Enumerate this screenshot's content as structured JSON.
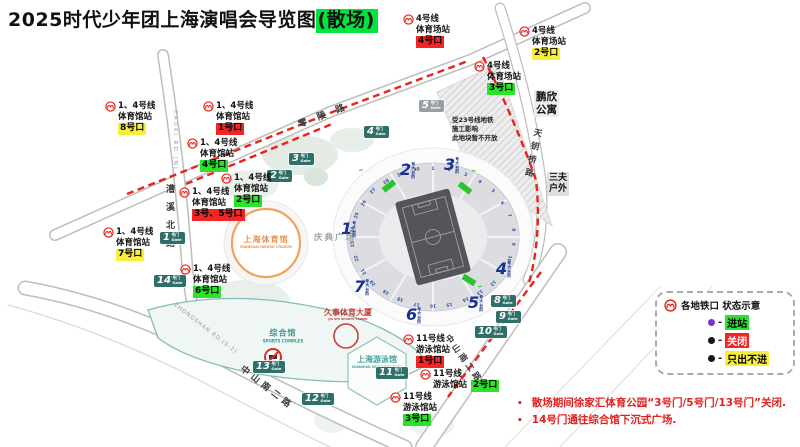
{
  "title": {
    "text": "2025时代少年团上海演唱会导览图",
    "tail": "(散场)"
  },
  "stations": [
    {
      "line": "4号线",
      "station": "体育场站",
      "exit": "4号口",
      "status": "closed",
      "x": 403,
      "y": 14
    },
    {
      "line": "4号线",
      "station": "体育场站",
      "exit": "2号口",
      "status": "exitonly",
      "x": 519,
      "y": 26
    },
    {
      "line": "4号线",
      "station": "体育场站",
      "exit": "3号口",
      "status": "open",
      "x": 474,
      "y": 61
    },
    {
      "line": "1、4号线",
      "station": "体育馆站",
      "exit": "8号口",
      "status": "exitonly",
      "x": 105,
      "y": 101
    },
    {
      "line": "1、4号线",
      "station": "体育馆站",
      "exit": "1号口",
      "status": "closed",
      "x": 203,
      "y": 101
    },
    {
      "line": "1、4号线",
      "station": "体育馆站",
      "exit": "4号口",
      "status": "open",
      "x": 187,
      "y": 138
    },
    {
      "line": "1、4号线",
      "station": "体育馆站",
      "exit": "2号口",
      "status": "open",
      "x": 221,
      "y": 173
    },
    {
      "line": "1、4号线",
      "station": "体育馆站",
      "exit": "3号、5号口",
      "status": "closed",
      "x": 179,
      "y": 187
    },
    {
      "line": "1、4号线",
      "station": "体育馆站",
      "exit": "7号口",
      "status": "exitonly",
      "x": 103,
      "y": 227
    },
    {
      "line": "1、4号线",
      "station": "体育馆站",
      "exit": "6号口",
      "status": "open",
      "x": 180,
      "y": 264
    },
    {
      "line": "11号线",
      "station": "游泳馆站",
      "exit": "1号口",
      "status": "closed",
      "x": 403,
      "y": 334
    },
    {
      "line": "11号线",
      "station": "游泳馆站",
      "exit": "2号口",
      "status": "open",
      "x": 420,
      "y": 369,
      "inline": true
    },
    {
      "line": "11号线",
      "station": "游泳馆站",
      "exit": "3号口",
      "status": "open",
      "x": 390,
      "y": 392
    }
  ],
  "gate_suffix": {
    "cn": "号门",
    "en": "Gate"
  },
  "gates": [
    {
      "num": "5",
      "x": 419,
      "y": 100,
      "closed": true
    },
    {
      "num": "4",
      "x": 364,
      "y": 126
    },
    {
      "num": "3",
      "x": 289,
      "y": 153
    },
    {
      "num": "2",
      "x": 267,
      "y": 170
    },
    {
      "num": "1",
      "x": 160,
      "y": 232
    },
    {
      "num": "14",
      "x": 154,
      "y": 275
    },
    {
      "num": "13",
      "x": 253,
      "y": 361
    },
    {
      "num": "12",
      "x": 302,
      "y": 393
    },
    {
      "num": "11",
      "x": 376,
      "y": 367
    },
    {
      "num": "10",
      "x": 475,
      "y": 326
    },
    {
      "num": "9",
      "x": 496,
      "y": 311
    },
    {
      "num": "8",
      "x": 491,
      "y": 295
    }
  ],
  "stair_suffix": "号大台阶",
  "stairs": [
    {
      "n": "1",
      "x": 341,
      "y": 221
    },
    {
      "n": "2",
      "x": 400,
      "y": 162
    },
    {
      "n": "3",
      "x": 444,
      "y": 157
    },
    {
      "n": "4",
      "x": 496,
      "y": 261
    },
    {
      "n": "5",
      "x": 468,
      "y": 295
    },
    {
      "n": "6",
      "x": 406,
      "y": 307
    },
    {
      "n": "7",
      "x": 354,
      "y": 279
    }
  ],
  "passages": [
    {
      "label": "1号内场通道",
      "x": 359,
      "y": 170,
      "rot": -10
    },
    {
      "label": "2号内场通道",
      "x": 472,
      "y": 170,
      "rot": 10
    },
    {
      "label": "3号内场通道",
      "x": 478,
      "y": 286,
      "rot": -4
    }
  ],
  "stadium": {
    "sections": [
      "1",
      "2",
      "3",
      "4",
      "5",
      "6",
      "7",
      "8",
      "9",
      "10",
      "11",
      "12",
      "13",
      "14",
      "15",
      "16",
      "17",
      "18",
      "19",
      "20",
      "21",
      "22",
      "23",
      "24",
      "25",
      "26",
      "27",
      "28",
      "29",
      "30"
    ]
  },
  "places": {
    "pengxin": "鹏欣\n公寓",
    "sanfu": "三夫\n户外",
    "plaza": "庆典广场",
    "indoor_cn": "上海体育馆",
    "indoor_en": "SHANGHAI INDOOR STADIUM",
    "complex_cn": "综合馆",
    "complex_en": "SPORTS COMPLEX",
    "swim_cn": "上海游泳馆",
    "swim_en": "SHANGHAI SWIMMING POOL",
    "tower_cn": "久事体育大厦",
    "tower_en": "JIU SHI SPORTS TOWER",
    "construction": "受23号线地铁\n施工影响\n此地块暂不开放"
  },
  "roads": {
    "lingling": "零陵路",
    "caoxi_cn": "漕溪北路",
    "caoxi_en": "CAOXI RD.(N)",
    "tianyaoqiao": "天钥桥路",
    "zhongshan_en": "ZHONGSHAN RD.(S-2)",
    "zhongshan_cn_left": "中山南二路",
    "zhongshan_cn_right": "中山南二路"
  },
  "legend": {
    "title": "各地铁口 状态示意",
    "prefix": "-",
    "items": [
      {
        "label": "进站",
        "cls": "open",
        "dot": "#7b2fd6"
      },
      {
        "label": "关闭",
        "cls": "closed",
        "dot": "#141414"
      },
      {
        "label": "只出不进",
        "cls": "exitonly",
        "dot": "#141414"
      }
    ]
  },
  "notes": [
    {
      "text": "散场期间徐家汇体育公园“3号门/5号门/13号门”关闭."
    },
    {
      "text": "14号门通往综合馆下沉式广场."
    }
  ]
}
